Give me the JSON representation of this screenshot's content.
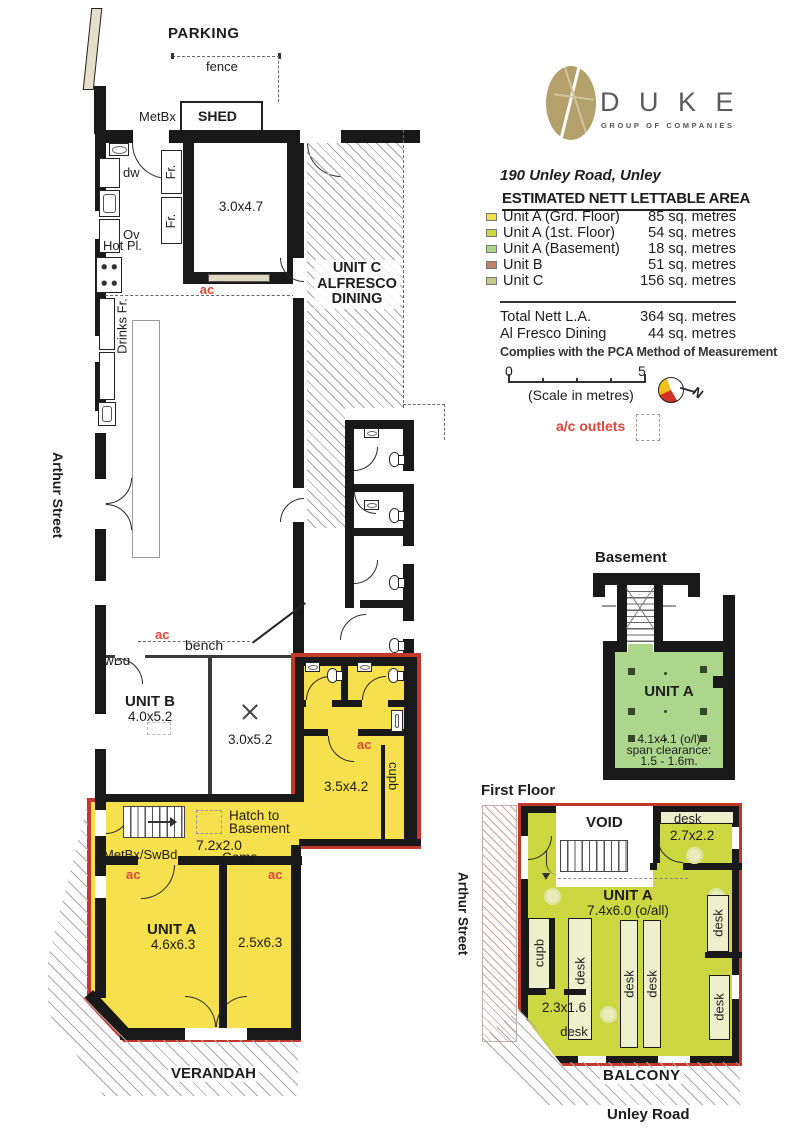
{
  "legend": {
    "brand": {
      "name": "D U K E",
      "tagline": "GROUP OF COMPANIES"
    },
    "address": "190 Unley Road, Unley",
    "table_title": "ESTIMATED NETT LETTABLE AREA",
    "rows": [
      {
        "label": "Unit A (Grd. Floor)",
        "value": "85 sq. metres",
        "color": "#f0e14a"
      },
      {
        "label": "Unit A (1st. Floor)",
        "value": "54 sq. metres",
        "color": "#ccd742"
      },
      {
        "label": "Unit A (Basement)",
        "value": "18 sq. metres",
        "color": "#a9d689"
      },
      {
        "label": "Unit B",
        "value": "51 sq. metres",
        "color": "#c57f69"
      },
      {
        "label": "Unit C",
        "value": "156 sq. metres",
        "color": "#c8c78b"
      }
    ],
    "totals": [
      {
        "label": "Total Nett L.A.",
        "value": "364 sq. metres"
      },
      {
        "label": "Al Fresco Dining",
        "value": "44 sq. metres"
      }
    ],
    "compliance": "Complies with the PCA Method of Measurement",
    "scale": {
      "zero": "0",
      "five": "5",
      "caption": "(Scale in metres)"
    },
    "north": "N",
    "ac_outlets": "a/c outlets"
  },
  "site": {
    "parking": "PARKING",
    "fence": "fence",
    "metbx": "MetBx",
    "shed": "SHED",
    "arthur_street": "Arthur Street",
    "verandah": "VERANDAH",
    "unley_road": "Unley Road",
    "basement_title": "Basement",
    "first_floor_title": "First Floor"
  },
  "gf": {
    "cool_room": "3.0x4.7",
    "dw": "dw",
    "ov": "Ov",
    "hot_pl": "Hot Pl.",
    "drinks_fr": "Drinks Fr.",
    "fr": "Fr.",
    "ac": "ac",
    "unit_c1": "UNIT C",
    "unit_c2": "ALFRESCO",
    "unit_c3": "DINING",
    "bench": "bench",
    "swbd": "SwBd",
    "unit_b": "UNIT B",
    "unit_b_dim": "4.0x5.2",
    "mid_room": "3.0x5.2",
    "room_3542": "3.5x4.2",
    "cupb": "cupb",
    "hatch1": "Hatch to",
    "hatch2": "Basement",
    "hall": "7.2x2.0",
    "metbx_swbd": "MetBx/SwBd",
    "coms": "Coms",
    "unit_a": "UNIT A",
    "unit_a_dim": "4.6x6.3",
    "room_2563": "2.5x6.3"
  },
  "bm": {
    "unit": "UNIT A",
    "dim": "4.1x4.1 (o/l)",
    "clr1": "span clearance:",
    "clr2": "1.5 - 1.6m."
  },
  "ff": {
    "void_label": "VOID",
    "desk": "desk",
    "room_2722": "2.7x2.2",
    "unit": "UNIT A",
    "dim": "7.4x6.0 (o/all)",
    "cupb": "cupb",
    "room_2316": "2.3x1.6",
    "balcony": "BALCONY"
  },
  "colors": {
    "wall": "#191919",
    "red_outline": "#c4372b",
    "ac_red": "#d8473a",
    "unit_a_ground": "#f6e04e",
    "unit_a_first": "#ccd742",
    "unit_a_basement": "#abd68b",
    "desk_fill": "#eef0cc",
    "brand_gold": "#b3a06b"
  }
}
